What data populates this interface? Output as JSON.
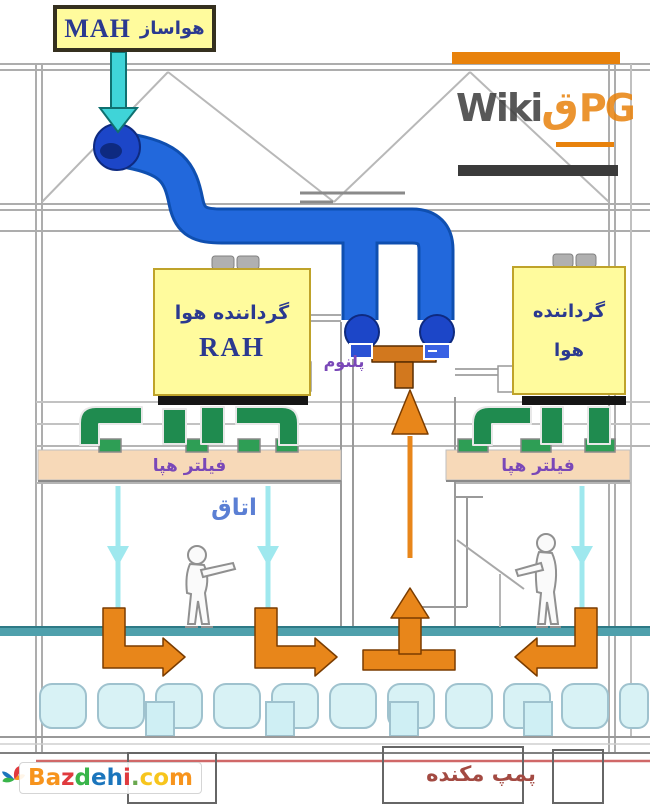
{
  "labels": {
    "mah_fa": "هواساز",
    "mah_en": "MAH",
    "rah_fa": "گرداننده هوا",
    "rah_en": "RAH",
    "right_unit_line1": "گرداننده",
    "right_unit_line2": "هوا",
    "plenum": "پلنوم",
    "filter_left": "فیلتر هپا",
    "filter_right": "فیلتر هپا",
    "room": "اتاق",
    "pump": "پمپ مکنده"
  },
  "watermarks": {
    "wikipg_dark": "Wiki",
    "wikipg_accent": "ق",
    "wikipg_orange": "PG",
    "bazdehi_letters": [
      {
        "ch": "B",
        "color": "#F7941D"
      },
      {
        "ch": "a",
        "color": "#F7941D"
      },
      {
        "ch": "z",
        "color": "#E03A3E"
      },
      {
        "ch": "d",
        "color": "#39B54A"
      },
      {
        "ch": "e",
        "color": "#1B75BC"
      },
      {
        "ch": "h",
        "color": "#1B75BC"
      },
      {
        "ch": "i",
        "color": "#E03A3E"
      },
      {
        "ch": ".",
        "color": "#6AA84F"
      },
      {
        "ch": "c",
        "color": "#F7C51D"
      },
      {
        "ch": "o",
        "color": "#F7C51D"
      },
      {
        "ch": "m",
        "color": "#F7941D"
      }
    ]
  },
  "colors": {
    "yellow": "#FFFB9D",
    "navy": "#2B3990",
    "duct-blue": "#2268DC",
    "duct-blue-dark": "#0F4FB0",
    "fan-blue": "#1C46C8",
    "cyan": "#3FD4D8",
    "cyan-light": "#9FE8EE",
    "green": "#1F8B4F",
    "orange": "#E8861A",
    "orange-dark": "#D2781E",
    "filter-peach": "#F7D9B8",
    "floor-teal": "#4FA0AC",
    "purple": "#7A48B8",
    "room-blue": "#5B7FD4",
    "maroon": "#A34A42",
    "wiki-orange": "#E8820C",
    "wiki-dark": "#3B3B3B",
    "subfloor-cyan": "#D8F2F5",
    "red-line": "#D06868"
  }
}
